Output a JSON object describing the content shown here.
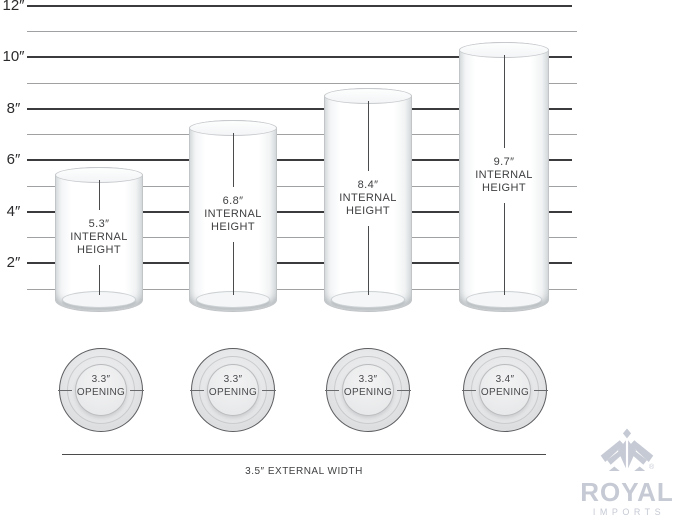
{
  "ruler": {
    "unit_labels": [
      "12″",
      "10″",
      "8″",
      "6″",
      "4″",
      "2″"
    ]
  },
  "vases": [
    {
      "value": "5.3″",
      "caption_line1": "INTERNAL",
      "caption_line2": "HEIGHT"
    },
    {
      "value": "6.8″",
      "caption_line1": "INTERNAL",
      "caption_line2": "HEIGHT"
    },
    {
      "value": "8.4″",
      "caption_line1": "INTERNAL",
      "caption_line2": "HEIGHT"
    },
    {
      "value": "9.7″",
      "caption_line1": "INTERNAL",
      "caption_line2": "HEIGHT"
    }
  ],
  "openings": [
    {
      "value": "3.3″",
      "caption": "OPENING"
    },
    {
      "value": "3.3″",
      "caption": "OPENING"
    },
    {
      "value": "3.3″",
      "caption": "OPENING"
    },
    {
      "value": "3.4″",
      "caption": "OPENING"
    }
  ],
  "footer": {
    "external_width": "3.5″ EXTERNAL WIDTH"
  },
  "brand": {
    "name": "ROYAL",
    "subtitle": "IMPORTS",
    "registered_mark": "®"
  },
  "colors": {
    "major_line": "#3b3b3d",
    "minor_line": "#9fa1a3",
    "label_text": "#2b2b2d",
    "dimension_text": "#3f4042",
    "brand_text": "#c6cad4"
  }
}
